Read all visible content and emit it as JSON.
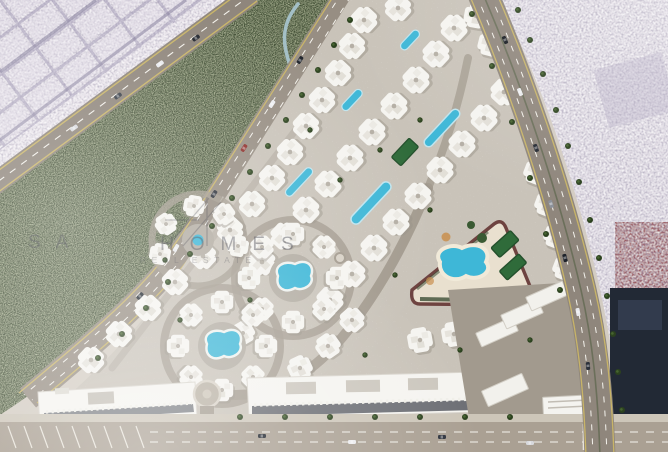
{
  "watermark": {
    "brand_left": "SA",
    "brand_right": "HOMES",
    "tagline": "REAL ESTATE"
  },
  "palette": {
    "city_left_base": "#cfc8d6",
    "city_left_light": "#e6e0e8",
    "city_right_base": "#dcd6e0",
    "grid_line": "#a29ab6",
    "greenbelt": "#3d4a31",
    "belt_path": "#a9c6d1",
    "road_surface": "#8f867c",
    "road_inner": "#978e83",
    "road_bottom": "#aaa093",
    "sidewalk": "#cdc6b9",
    "lane_yellow": "#c8b468",
    "lane_white": "#f4f2ec",
    "compound_ground": "#c9c3b9",
    "internal_road": "#a49c90",
    "building_white": "#f5f4f0",
    "pool_water": "#3eb7d7",
    "sand_deck": "#e9e0cf",
    "court_green": "#2f6b3a",
    "track_red": "#6e4340",
    "hedge_green": "#31452c",
    "dark_block": "#222935",
    "red_block": "#9b5a60",
    "warehouse_yard": "#a29a8e",
    "watermark_ink": "#3a3a44"
  }
}
